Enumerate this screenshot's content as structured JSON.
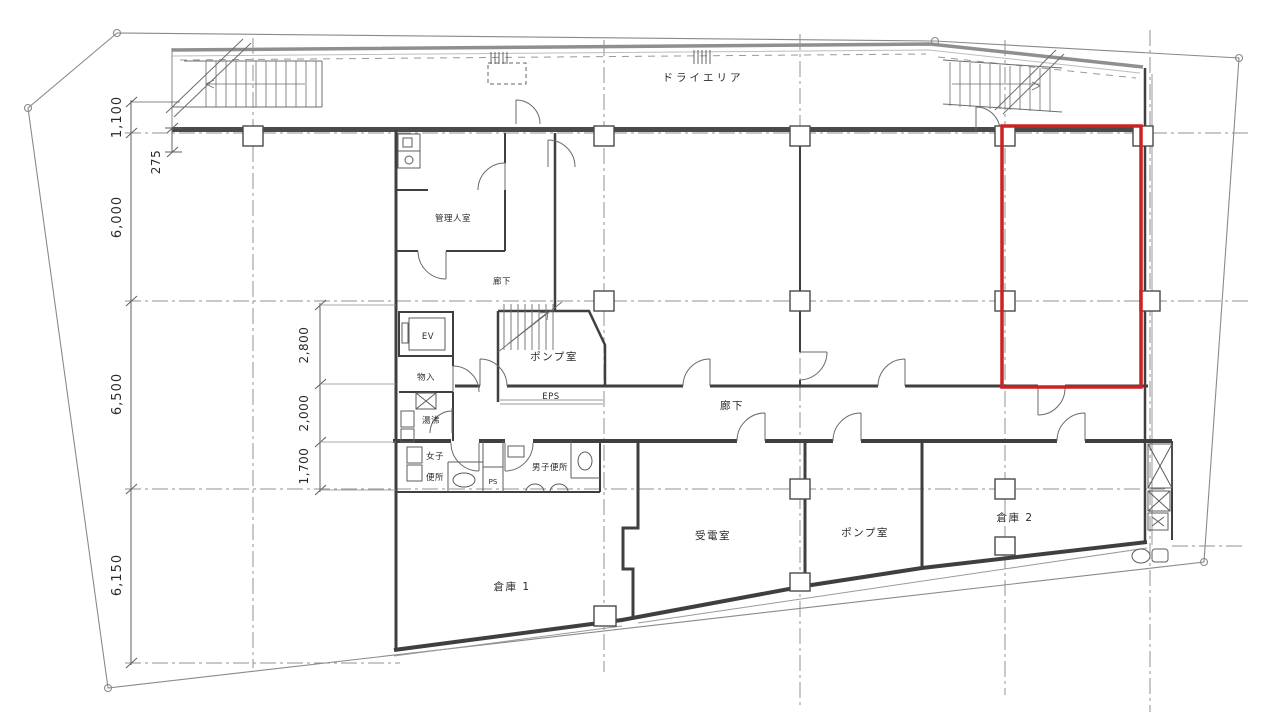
{
  "rooms": {
    "dry_area": "ドライエリア",
    "manager": "管理人室",
    "corridor_upper": "廊下",
    "corridor_lower": "廊下",
    "elevator": "EV",
    "storage": "物入",
    "hot_water": "湯沸",
    "pump_mid": "ポンプ室",
    "eps": "EPS",
    "ps": "PS",
    "women_line1": "女子",
    "women_line2": "便所",
    "men": "男子便所",
    "warehouse1": "倉庫 1",
    "power": "受電室",
    "pump_lower": "ポンプ室",
    "warehouse2": "倉庫 2"
  },
  "dimensions": {
    "left": [
      "1,100",
      "275",
      "6,000",
      "6,500",
      "6,150"
    ],
    "middle": [
      "2,800",
      "2,000",
      "1,700"
    ]
  },
  "colors": {
    "highlight": "#cc2222",
    "walls": "#3f3f3f",
    "lines": "#777777"
  }
}
